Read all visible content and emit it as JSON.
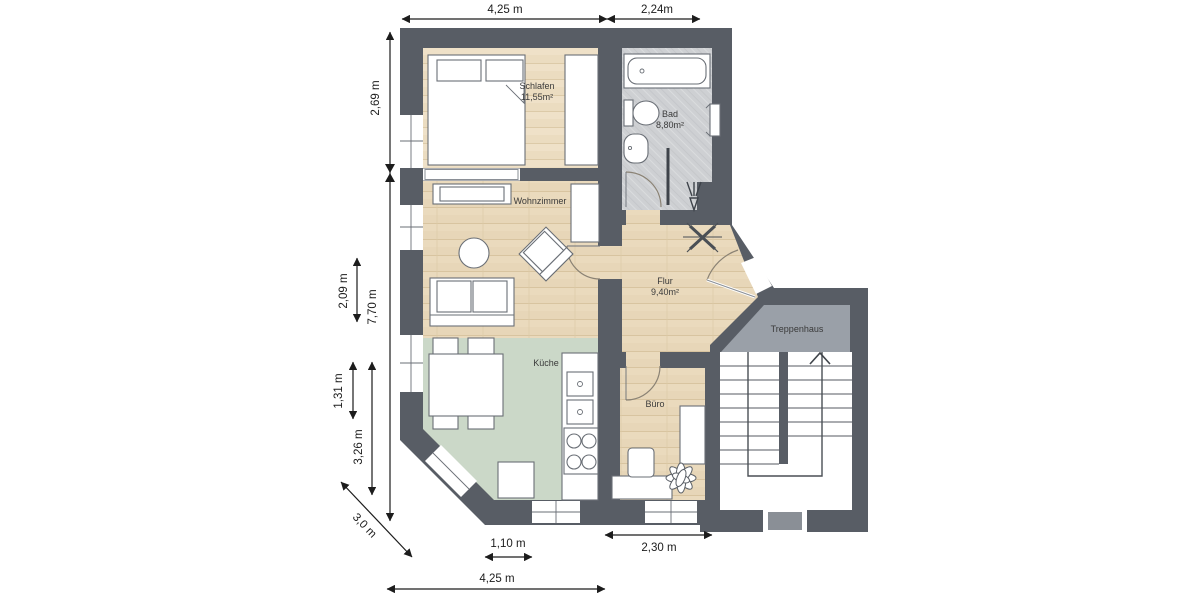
{
  "plan_title": "Apartment floor plan",
  "colors": {
    "wall": "#585d65",
    "wood": "#e7d6b8",
    "wood_light": "#ecdcc1",
    "kitchen_floor": "#cbd8c8",
    "bath_floor": "#ced0d3",
    "landing": "#9aa0a8"
  },
  "rooms": {
    "schlafen": {
      "label": "Schlafen",
      "area": "11,55m²"
    },
    "bad": {
      "label": "Bad",
      "area": "8,80m²"
    },
    "wohnzimmer": {
      "label": "Wohnzimmer"
    },
    "flur": {
      "label": "Flur",
      "area": "9,40m²"
    },
    "kueche": {
      "label": "Küche"
    },
    "buero": {
      "label": "Büro"
    },
    "treppenhaus": {
      "label": "Treppenhaus"
    }
  },
  "dimensions": {
    "top_main": "4,25 m",
    "top_bath": "2,24m",
    "left_upper": "2,69 m",
    "left_total": "7,70 m",
    "left_living": "2,09 m",
    "left_kitchen_window": "1,31 m",
    "left_kitchen": "3,26 m",
    "diagonal": "3,0 m",
    "bottom_window": "1,10 m",
    "bottom_office": "2,30 m",
    "bottom_main": "4,25 m"
  }
}
